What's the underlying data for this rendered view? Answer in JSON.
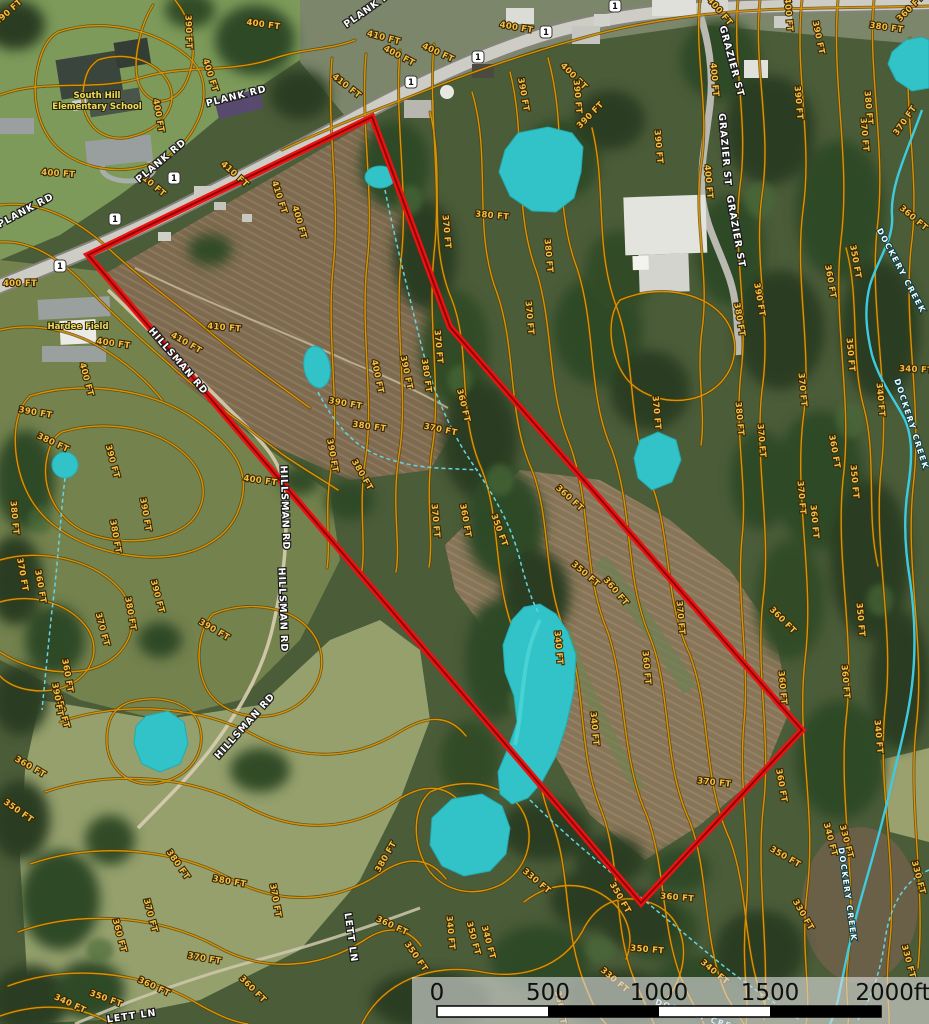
{
  "colors": {
    "boundary": "#e81414",
    "boundary_core": "#8f0000",
    "contour": "#d4940a",
    "contour_casing": "#5c3d00",
    "pond": "#31c3c7",
    "creek": "#3ecbe0",
    "road": "#cdcdc6"
  },
  "boundary": {
    "points": "372,117 450,327 802,730 641,903 88,255"
  },
  "scalebar": {
    "ticks": [
      "0",
      "500",
      "1000",
      "1500",
      "2000ft"
    ]
  },
  "labels": {
    "contours": [
      {
        "t": "390 FT",
        "x": 10,
        "y": 14,
        "r": -42
      },
      {
        "t": "400 FT",
        "x": 263,
        "y": 27,
        "r": 8
      },
      {
        "t": "390 FT",
        "x": 186,
        "y": 32,
        "r": 88
      },
      {
        "t": "400 FT",
        "x": 208,
        "y": 76,
        "r": 72
      },
      {
        "t": "400 FT",
        "x": 156,
        "y": 116,
        "r": 80
      },
      {
        "t": "400 FT",
        "x": 58,
        "y": 176,
        "r": 4
      },
      {
        "t": "410 FT",
        "x": 150,
        "y": 186,
        "r": 40
      },
      {
        "t": "410 FT",
        "x": 233,
        "y": 176,
        "r": 42
      },
      {
        "t": "410 FT",
        "x": 277,
        "y": 198,
        "r": 72
      },
      {
        "t": "400 FT",
        "x": 297,
        "y": 223,
        "r": 74
      },
      {
        "t": "400 FT",
        "x": 20,
        "y": 286,
        "r": 0
      },
      {
        "t": "400 FT",
        "x": 113,
        "y": 346,
        "r": 8
      },
      {
        "t": "390 FT",
        "x": 35,
        "y": 415,
        "r": 10
      },
      {
        "t": "380 FT",
        "x": 52,
        "y": 445,
        "r": 25
      },
      {
        "t": "390 FT",
        "x": 110,
        "y": 462,
        "r": 75
      },
      {
        "t": "390 FT",
        "x": 143,
        "y": 515,
        "r": 80
      },
      {
        "t": "380 FT",
        "x": 113,
        "y": 537,
        "r": 80
      },
      {
        "t": "380 FT",
        "x": 12,
        "y": 518,
        "r": 85
      },
      {
        "t": "370 FT",
        "x": 20,
        "y": 575,
        "r": 80
      },
      {
        "t": "360 FT",
        "x": 38,
        "y": 587,
        "r": 80
      },
      {
        "t": "370 FT",
        "x": 100,
        "y": 630,
        "r": 75
      },
      {
        "t": "380 FT",
        "x": 128,
        "y": 614,
        "r": 80
      },
      {
        "t": "360 FT",
        "x": 65,
        "y": 676,
        "r": 80
      },
      {
        "t": "350 FT",
        "x": 60,
        "y": 712,
        "r": 75
      },
      {
        "t": "390 FT",
        "x": 213,
        "y": 632,
        "r": 30
      },
      {
        "t": "390 FT",
        "x": 155,
        "y": 597,
        "r": 75
      },
      {
        "t": "410 FT",
        "x": 383,
        "y": 40,
        "r": 15
      },
      {
        "t": "400 FT",
        "x": 398,
        "y": 58,
        "r": 28
      },
      {
        "t": "410 FT",
        "x": 345,
        "y": 88,
        "r": 38
      },
      {
        "t": "400 FT",
        "x": 437,
        "y": 55,
        "r": 25
      },
      {
        "t": "400 FT",
        "x": 516,
        "y": 30,
        "r": 10
      },
      {
        "t": "400 FT",
        "x": 572,
        "y": 78,
        "r": 45
      },
      {
        "t": "390 FT",
        "x": 521,
        "y": 95,
        "r": 80
      },
      {
        "t": "390 FT",
        "x": 575,
        "y": 97,
        "r": 85
      },
      {
        "t": "390 FT",
        "x": 592,
        "y": 117,
        "r": -45
      },
      {
        "t": "410 FT",
        "x": 185,
        "y": 345,
        "r": 30
      },
      {
        "t": "400 FT",
        "x": 84,
        "y": 380,
        "r": 75
      },
      {
        "t": "410 FT",
        "x": 224,
        "y": 330,
        "r": 5
      },
      {
        "t": "400 FT",
        "x": 260,
        "y": 483,
        "r": 8
      },
      {
        "t": "400 FT",
        "x": 375,
        "y": 377,
        "r": 78
      },
      {
        "t": "390 FT",
        "x": 404,
        "y": 373,
        "r": 78
      },
      {
        "t": "380 FT",
        "x": 424,
        "y": 376,
        "r": 82
      },
      {
        "t": "370 FT",
        "x": 436,
        "y": 347,
        "r": 85
      },
      {
        "t": "360 FT",
        "x": 461,
        "y": 406,
        "r": 76
      },
      {
        "t": "390 FT",
        "x": 345,
        "y": 406,
        "r": 10
      },
      {
        "t": "380 FT",
        "x": 369,
        "y": 429,
        "r": 8
      },
      {
        "t": "370 FT",
        "x": 440,
        "y": 432,
        "r": 12
      },
      {
        "t": "390 FT",
        "x": 330,
        "y": 456,
        "r": 80
      },
      {
        "t": "380 FT",
        "x": 360,
        "y": 476,
        "r": 60
      },
      {
        "t": "370 FT",
        "x": 433,
        "y": 521,
        "r": 85
      },
      {
        "t": "360 FT",
        "x": 463,
        "y": 521,
        "r": 80
      },
      {
        "t": "350 FT",
        "x": 497,
        "y": 531,
        "r": 70
      },
      {
        "t": "370 FT",
        "x": 444,
        "y": 232,
        "r": 85
      },
      {
        "t": "380 FT",
        "x": 546,
        "y": 256,
        "r": 85
      },
      {
        "t": "380 FT",
        "x": 492,
        "y": 218,
        "r": 5
      },
      {
        "t": "370 FT",
        "x": 527,
        "y": 318,
        "r": 85
      },
      {
        "t": "360 FT",
        "x": 568,
        "y": 500,
        "r": 42
      },
      {
        "t": "340 FT",
        "x": 556,
        "y": 648,
        "r": 85
      },
      {
        "t": "400 FT",
        "x": 718,
        "y": 13,
        "r": 50
      },
      {
        "t": "400 FT",
        "x": 786,
        "y": 15,
        "r": 85
      },
      {
        "t": "390 FT",
        "x": 816,
        "y": 38,
        "r": 78
      },
      {
        "t": "380 FT",
        "x": 886,
        "y": 30,
        "r": 8
      },
      {
        "t": "360 FT",
        "x": 912,
        "y": 10,
        "r": -45
      },
      {
        "t": "400 FT",
        "x": 712,
        "y": 80,
        "r": 85
      },
      {
        "t": "390 FT",
        "x": 796,
        "y": 103,
        "r": 85
      },
      {
        "t": "380 FT",
        "x": 866,
        "y": 108,
        "r": 85
      },
      {
        "t": "370 FT",
        "x": 907,
        "y": 122,
        "r": -55
      },
      {
        "t": "390 FT",
        "x": 656,
        "y": 147,
        "r": 85
      },
      {
        "t": "400 FT",
        "x": 706,
        "y": 182,
        "r": 85
      },
      {
        "t": "380 FT",
        "x": 737,
        "y": 320,
        "r": 80
      },
      {
        "t": "390 FT",
        "x": 757,
        "y": 300,
        "r": 80
      },
      {
        "t": "370 FT",
        "x": 862,
        "y": 135,
        "r": 85
      },
      {
        "t": "360 FT",
        "x": 912,
        "y": 220,
        "r": 40
      },
      {
        "t": "340 FT",
        "x": 916,
        "y": 372,
        "r": 3
      },
      {
        "t": "350 FT",
        "x": 853,
        "y": 262,
        "r": 80
      },
      {
        "t": "360 FT",
        "x": 828,
        "y": 282,
        "r": 80
      },
      {
        "t": "350 FT",
        "x": 848,
        "y": 355,
        "r": 85
      },
      {
        "t": "340 FT",
        "x": 878,
        "y": 400,
        "r": 85
      },
      {
        "t": "370 FT",
        "x": 800,
        "y": 390,
        "r": 85
      },
      {
        "t": "360 FT",
        "x": 832,
        "y": 452,
        "r": 80
      },
      {
        "t": "350 FT",
        "x": 852,
        "y": 482,
        "r": 85
      },
      {
        "t": "360 FT",
        "x": 812,
        "y": 522,
        "r": 85
      },
      {
        "t": "350 FT",
        "x": 858,
        "y": 620,
        "r": 85
      },
      {
        "t": "360 FT",
        "x": 843,
        "y": 682,
        "r": 85
      },
      {
        "t": "340 FT",
        "x": 876,
        "y": 737,
        "r": 85
      },
      {
        "t": "370 FT",
        "x": 654,
        "y": 413,
        "r": 85
      },
      {
        "t": "380 FT",
        "x": 737,
        "y": 419,
        "r": 85
      },
      {
        "t": "370 FT",
        "x": 799,
        "y": 498,
        "r": 85
      },
      {
        "t": "350 FT",
        "x": 584,
        "y": 576,
        "r": 40
      },
      {
        "t": "360 FT",
        "x": 614,
        "y": 593,
        "r": 50
      },
      {
        "t": "370 FT",
        "x": 678,
        "y": 618,
        "r": 85
      },
      {
        "t": "360 FT",
        "x": 644,
        "y": 668,
        "r": 85
      },
      {
        "t": "370 FT",
        "x": 714,
        "y": 785,
        "r": 6
      },
      {
        "t": "340 FT",
        "x": 592,
        "y": 729,
        "r": 85
      },
      {
        "t": "330 FT",
        "x": 535,
        "y": 883,
        "r": 40
      },
      {
        "t": "350 FT",
        "x": 618,
        "y": 899,
        "r": 60
      },
      {
        "t": "360 FT",
        "x": 677,
        "y": 900,
        "r": 5
      },
      {
        "t": "360 FT",
        "x": 781,
        "y": 622,
        "r": 45
      },
      {
        "t": "360 FT",
        "x": 780,
        "y": 688,
        "r": 85
      },
      {
        "t": "370 FT",
        "x": 759,
        "y": 441,
        "r": 85
      },
      {
        "t": "380 FT",
        "x": 176,
        "y": 866,
        "r": 55
      },
      {
        "t": "380 FT",
        "x": 229,
        "y": 884,
        "r": 10
      },
      {
        "t": "370 FT",
        "x": 148,
        "y": 916,
        "r": 75
      },
      {
        "t": "370 FT",
        "x": 273,
        "y": 901,
        "r": 80
      },
      {
        "t": "360 FT",
        "x": 117,
        "y": 936,
        "r": 75
      },
      {
        "t": "370 FT",
        "x": 204,
        "y": 961,
        "r": 10
      },
      {
        "t": "360 FT",
        "x": 153,
        "y": 989,
        "r": 25
      },
      {
        "t": "350 FT",
        "x": 105,
        "y": 1001,
        "r": 20
      },
      {
        "t": "340 FT",
        "x": 69,
        "y": 1006,
        "r": 25
      },
      {
        "t": "360 FT",
        "x": 251,
        "y": 991,
        "r": 45
      },
      {
        "t": "380 FT",
        "x": 388,
        "y": 858,
        "r": -60
      },
      {
        "t": "360 FT",
        "x": 29,
        "y": 769,
        "r": 30
      },
      {
        "t": "350 FT",
        "x": 17,
        "y": 813,
        "r": 35
      },
      {
        "t": "390 FT",
        "x": 55,
        "y": 700,
        "r": 80
      },
      {
        "t": "360 FT",
        "x": 391,
        "y": 928,
        "r": 25
      },
      {
        "t": "350 FT",
        "x": 414,
        "y": 958,
        "r": 55
      },
      {
        "t": "350 FT",
        "x": 471,
        "y": 939,
        "r": 75
      },
      {
        "t": "340 FT",
        "x": 486,
        "y": 943,
        "r": 75
      },
      {
        "t": "340 FT",
        "x": 448,
        "y": 933,
        "r": 85
      },
      {
        "t": "350 FT",
        "x": 558,
        "y": 1008,
        "r": 80
      },
      {
        "t": "330 FT",
        "x": 613,
        "y": 982,
        "r": 40
      },
      {
        "t": "340 FT",
        "x": 713,
        "y": 974,
        "r": 40
      },
      {
        "t": "350 FT",
        "x": 647,
        "y": 952,
        "r": 5
      },
      {
        "t": "350 FT",
        "x": 784,
        "y": 859,
        "r": 30
      },
      {
        "t": "330 FT",
        "x": 801,
        "y": 916,
        "r": 60
      },
      {
        "t": "340 FT",
        "x": 828,
        "y": 840,
        "r": 75
      },
      {
        "t": "330 FT",
        "x": 844,
        "y": 842,
        "r": 75
      },
      {
        "t": "360 FT",
        "x": 779,
        "y": 786,
        "r": 80
      },
      {
        "t": "330 FT",
        "x": 916,
        "y": 878,
        "r": 75
      },
      {
        "t": "330 FT",
        "x": 906,
        "y": 962,
        "r": 75
      }
    ],
    "roads": [
      {
        "t": "PLANK RD",
        "x": 372,
        "y": 10,
        "r": -35
      },
      {
        "t": "PLANK RD",
        "x": 237,
        "y": 99,
        "r": -14
      },
      {
        "t": "PLANK RD",
        "x": 163,
        "y": 163,
        "r": -40
      },
      {
        "t": "PLANK RD",
        "x": 27,
        "y": 213,
        "r": -28
      },
      {
        "t": "GRAZIER ST",
        "x": 729,
        "y": 62,
        "r": 75
      },
      {
        "t": "GRAZIER ST",
        "x": 722,
        "y": 150,
        "r": 85
      },
      {
        "t": "GRAZIER ST",
        "x": 733,
        "y": 232,
        "r": 80
      },
      {
        "t": "HILLSMAN RD",
        "x": 176,
        "y": 363,
        "r": 49
      },
      {
        "t": "HILLSMAN RD",
        "x": 282,
        "y": 508,
        "r": 88
      },
      {
        "t": "HILLSMAN RD",
        "x": 280,
        "y": 610,
        "r": 88
      },
      {
        "t": "HILLSMAN RD",
        "x": 247,
        "y": 728,
        "r": -48
      },
      {
        "t": "LETT LN",
        "x": 348,
        "y": 938,
        "r": 82
      },
      {
        "t": "LETT LN",
        "x": 132,
        "y": 1019,
        "r": -8
      }
    ],
    "creeks": [
      {
        "t": "DOCKERY CREEK",
        "x": 899,
        "y": 272,
        "r": 62
      },
      {
        "t": "DOCKERY CREEK",
        "x": 909,
        "y": 425,
        "r": 72
      },
      {
        "t": "DOCKERY CREEK",
        "x": 845,
        "y": 895,
        "r": 82
      },
      {
        "t": "DOCKERY CREEK",
        "x": 700,
        "y": 1019,
        "r": 18
      }
    ],
    "pois": [
      {
        "t": "South Hill",
        "x": 97,
        "y": 98,
        "r": 0
      },
      {
        "t": "Elementary School",
        "x": 97,
        "y": 109,
        "r": 0
      },
      {
        "t": "Hardee Field",
        "x": 78,
        "y": 329,
        "r": 0
      }
    ],
    "shields": [
      {
        "t": "1",
        "x": 615,
        "y": 6
      },
      {
        "t": "1",
        "x": 546,
        "y": 32
      },
      {
        "t": "1",
        "x": 478,
        "y": 57
      },
      {
        "t": "1",
        "x": 411,
        "y": 82
      },
      {
        "t": "1",
        "x": 174,
        "y": 178
      },
      {
        "t": "1",
        "x": 115,
        "y": 219
      },
      {
        "t": "1",
        "x": 60,
        "y": 266
      }
    ]
  }
}
